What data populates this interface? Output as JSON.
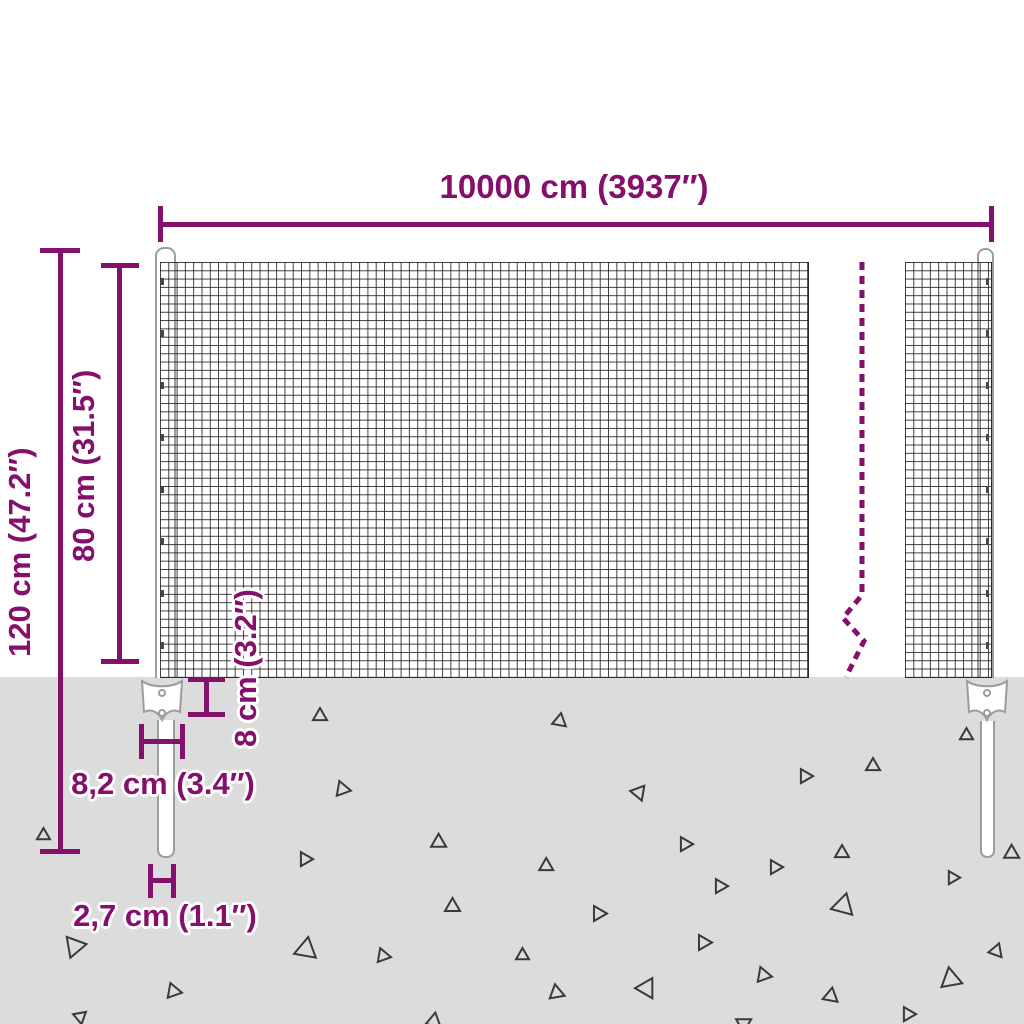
{
  "colors": {
    "accent": "#84106c",
    "ground": "#dcdcdc",
    "mesh_line": "#232323",
    "post_stroke": "#9c9c9c",
    "triangle_stroke": "#3a3a3a"
  },
  "labels": {
    "width": "10000 cm (3937″)",
    "height_total": "120 cm (47.2″)",
    "height_mesh": "80 cm (31.5″)",
    "anchor_depth": "8 cm (3.2″)",
    "plate_width": "8,2 cm (3.4″)",
    "post_diameter": "2,7 cm (1.1″)"
  },
  "ground": {
    "triangles": [
      {
        "x": 313,
        "y": 708,
        "s": 14,
        "r": 0
      },
      {
        "x": 337,
        "y": 783,
        "s": 15,
        "r": 100
      },
      {
        "x": 553,
        "y": 713,
        "s": 14,
        "r": 10
      },
      {
        "x": 632,
        "y": 788,
        "s": 15,
        "r": 160
      },
      {
        "x": 800,
        "y": 770,
        "s": 14,
        "r": 90
      },
      {
        "x": 866,
        "y": 758,
        "s": 14,
        "r": 0
      },
      {
        "x": 960,
        "y": 728,
        "s": 13,
        "r": 0
      },
      {
        "x": 37,
        "y": 828,
        "s": 13,
        "r": 0
      },
      {
        "x": 433,
        "y": 837,
        "s": 15,
        "r": 120
      },
      {
        "x": 680,
        "y": 838,
        "s": 14,
        "r": 90
      },
      {
        "x": 835,
        "y": 845,
        "s": 14,
        "r": 0
      },
      {
        "x": 1006,
        "y": 848,
        "s": 15,
        "r": 120
      },
      {
        "x": 300,
        "y": 853,
        "s": 14,
        "r": 90
      },
      {
        "x": 541,
        "y": 861,
        "s": 14,
        "r": 120
      },
      {
        "x": 770,
        "y": 861,
        "s": 14,
        "r": 90
      },
      {
        "x": 948,
        "y": 872,
        "s": 13,
        "r": 90
      },
      {
        "x": 715,
        "y": 880,
        "s": 14,
        "r": 90
      },
      {
        "x": 833,
        "y": 893,
        "s": 22,
        "r": 15
      },
      {
        "x": 445,
        "y": 898,
        "s": 15,
        "r": 0
      },
      {
        "x": 593,
        "y": 907,
        "s": 15,
        "r": 90
      },
      {
        "x": 63,
        "y": 940,
        "s": 21,
        "r": 200
      },
      {
        "x": 292,
        "y": 941,
        "s": 22,
        "r": 250
      },
      {
        "x": 378,
        "y": 950,
        "s": 14,
        "r": 100
      },
      {
        "x": 698,
        "y": 936,
        "s": 15,
        "r": 90
      },
      {
        "x": 516,
        "y": 948,
        "s": 13,
        "r": 0
      },
      {
        "x": 990,
        "y": 943,
        "s": 14,
        "r": 20
      },
      {
        "x": 551,
        "y": 987,
        "s": 15,
        "r": 110
      },
      {
        "x": 638,
        "y": 982,
        "s": 20,
        "r": 150
      },
      {
        "x": 758,
        "y": 969,
        "s": 15,
        "r": 100
      },
      {
        "x": 825,
        "y": 991,
        "s": 15,
        "r": 130
      },
      {
        "x": 938,
        "y": 972,
        "s": 21,
        "r": 230
      },
      {
        "x": 168,
        "y": 985,
        "s": 15,
        "r": 100
      },
      {
        "x": 74,
        "y": 1013,
        "s": 13,
        "r": 170
      },
      {
        "x": 428,
        "y": 1016,
        "s": 15,
        "r": 130
      },
      {
        "x": 903,
        "y": 1008,
        "s": 14,
        "r": 90
      },
      {
        "x": 738,
        "y": 1016,
        "s": 15,
        "r": 60
      }
    ]
  }
}
